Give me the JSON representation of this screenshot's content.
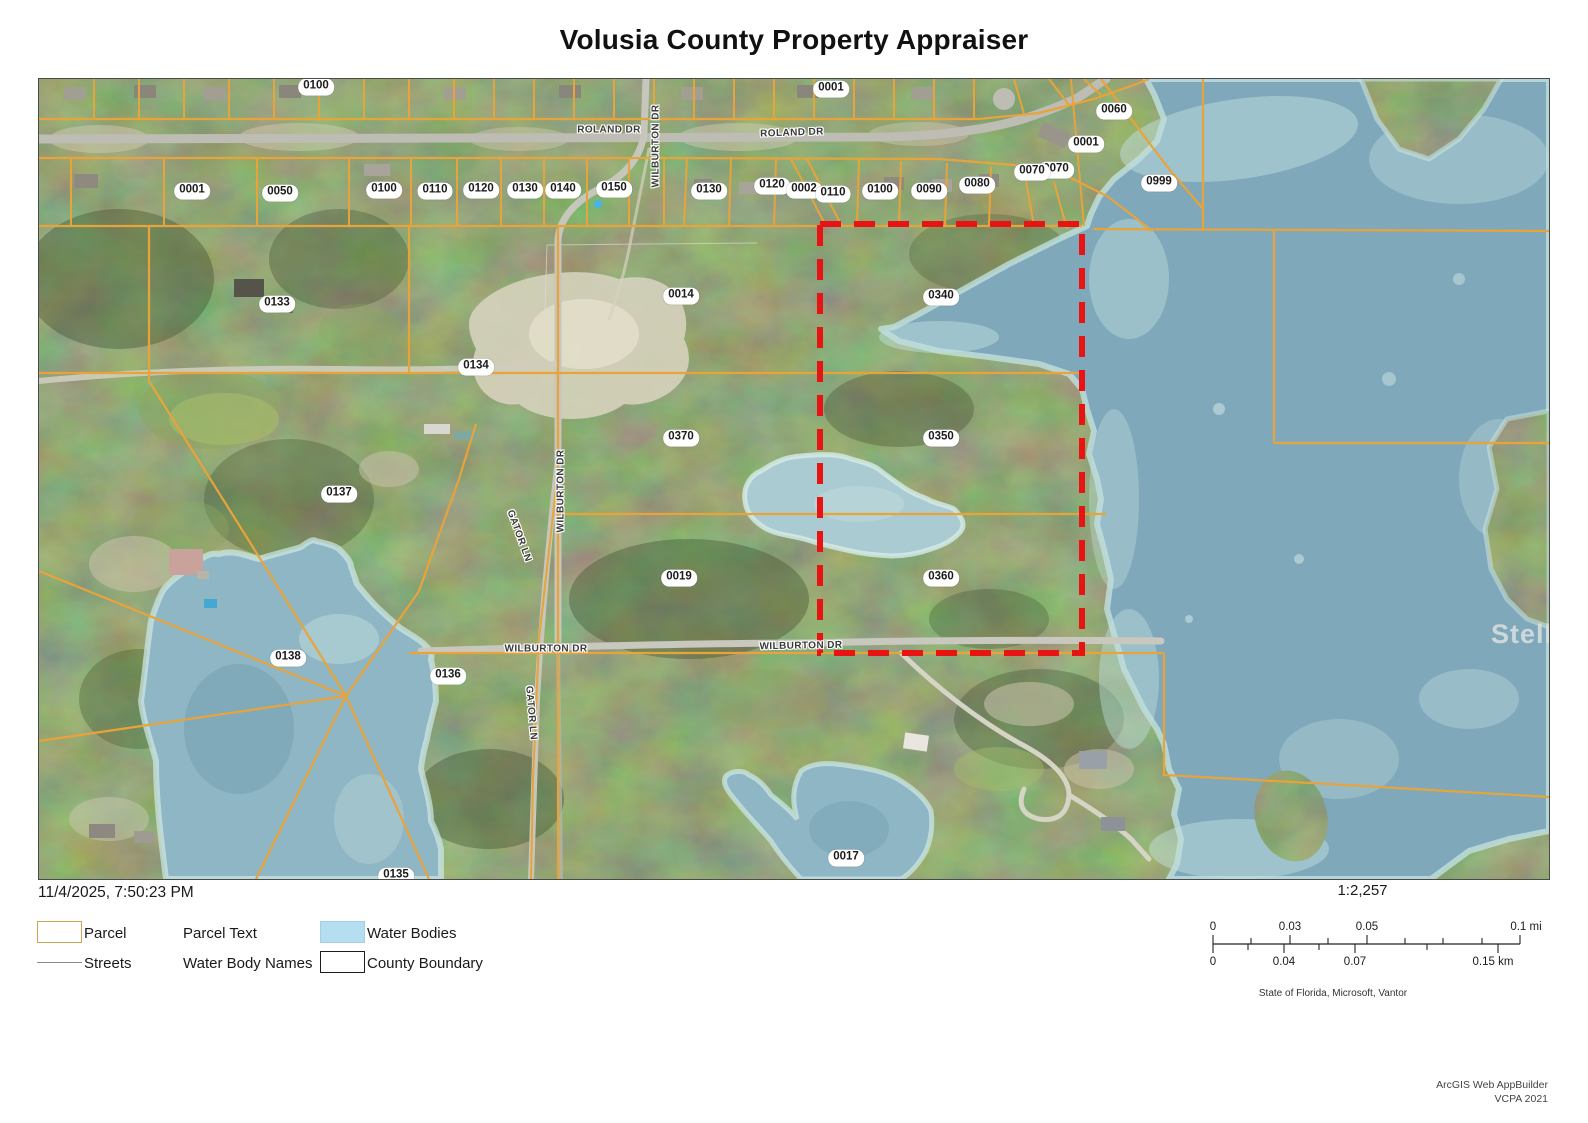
{
  "title": "Volusia County Property Appraiser",
  "map": {
    "watermark": "StellarMLS",
    "colors": {
      "parcel_line": "#E8A33B",
      "subject_boundary": "#E81313",
      "water": "#7FA8BA",
      "legend_water_swatch": "#B5DEF0"
    },
    "parcel_labels": [
      {
        "t": "0100",
        "x": 277,
        "y": 8
      },
      {
        "t": "0001",
        "x": 792,
        "y": 10
      },
      {
        "t": "0060",
        "x": 1075,
        "y": 32
      },
      {
        "t": "0001",
        "x": 1047,
        "y": 65
      },
      {
        "t": "0070",
        "x": 1017,
        "y": 91
      },
      {
        "t": "0999",
        "x": 1120,
        "y": 104
      },
      {
        "t": "0001",
        "x": 153,
        "y": 112
      },
      {
        "t": "0050",
        "x": 241,
        "y": 114
      },
      {
        "t": "0100",
        "x": 345,
        "y": 111
      },
      {
        "t": "0110",
        "x": 396,
        "y": 112
      },
      {
        "t": "0120",
        "x": 442,
        "y": 111
      },
      {
        "t": "0130",
        "x": 486,
        "y": 111
      },
      {
        "t": "0140",
        "x": 524,
        "y": 111
      },
      {
        "t": "0150",
        "x": 575,
        "y": 110
      },
      {
        "t": "0130",
        "x": 670,
        "y": 112
      },
      {
        "t": "0120",
        "x": 733,
        "y": 107
      },
      {
        "t": "0002",
        "x": 765,
        "y": 111
      },
      {
        "t": "0110",
        "x": 794,
        "y": 115
      },
      {
        "t": "0100",
        "x": 841,
        "y": 112
      },
      {
        "t": "0090",
        "x": 890,
        "y": 112
      },
      {
        "t": "0080",
        "x": 938,
        "y": 106
      },
      {
        "t": "0070",
        "x": 993,
        "y": 93
      },
      {
        "t": "0133",
        "x": 238,
        "y": 225
      },
      {
        "t": "0014",
        "x": 642,
        "y": 217
      },
      {
        "t": "0340",
        "x": 902,
        "y": 218
      },
      {
        "t": "0134",
        "x": 437,
        "y": 288
      },
      {
        "t": "0370",
        "x": 642,
        "y": 359
      },
      {
        "t": "0350",
        "x": 902,
        "y": 359
      },
      {
        "t": "0137",
        "x": 300,
        "y": 415
      },
      {
        "t": "0019",
        "x": 640,
        "y": 499
      },
      {
        "t": "0360",
        "x": 902,
        "y": 499
      },
      {
        "t": "0138",
        "x": 249,
        "y": 579
      },
      {
        "t": "0136",
        "x": 409,
        "y": 597
      },
      {
        "t": "0017",
        "x": 807,
        "y": 779
      },
      {
        "t": "0135",
        "x": 357,
        "y": 797
      }
    ],
    "street_labels": [
      {
        "t": "ROLAND DR",
        "x": 570,
        "y": 51,
        "r": 0
      },
      {
        "t": "ROLAND DR",
        "x": 753,
        "y": 54,
        "r": -2
      },
      {
        "t": "WILBURTON DR",
        "x": 617,
        "y": 67,
        "r": -90
      },
      {
        "t": "WILBURTON DR",
        "x": 522,
        "y": 412,
        "r": -90
      },
      {
        "t": "GATOR LN",
        "x": 480,
        "y": 457,
        "r": 70
      },
      {
        "t": "GATOR LN",
        "x": 492,
        "y": 634,
        "r": 85
      },
      {
        "t": "WILBURTON DR",
        "x": 507,
        "y": 570,
        "r": 0
      },
      {
        "t": "WILBURTON DR",
        "x": 762,
        "y": 567,
        "r": -1
      }
    ]
  },
  "footer": {
    "timestamp": "11/4/2025, 7:50:23 PM",
    "legend": {
      "parcel": "Parcel",
      "parcel_text": "Parcel Text",
      "water_bodies": "Water Bodies",
      "streets": "Streets",
      "water_body_names": "Water Body Names",
      "county_boundary": "County Boundary"
    },
    "scale": {
      "ratio": "1:2,257",
      "mi_labels": [
        {
          "t": "0",
          "x": 33
        },
        {
          "t": "0.03",
          "x": 110
        },
        {
          "t": "0.05",
          "x": 187
        },
        {
          "t": "0.1 mi",
          "x": 346
        }
      ],
      "km_labels": [
        {
          "t": "0",
          "x": 33
        },
        {
          "t": "0.04",
          "x": 104
        },
        {
          "t": "0.07",
          "x": 175
        },
        {
          "t": "0.15 km",
          "x": 313
        }
      ]
    },
    "attribution": "State of Florida, Microsoft, Vantor",
    "credit_line1": "ArcGIS Web AppBuilder",
    "credit_line2": "VCPA 2021"
  }
}
